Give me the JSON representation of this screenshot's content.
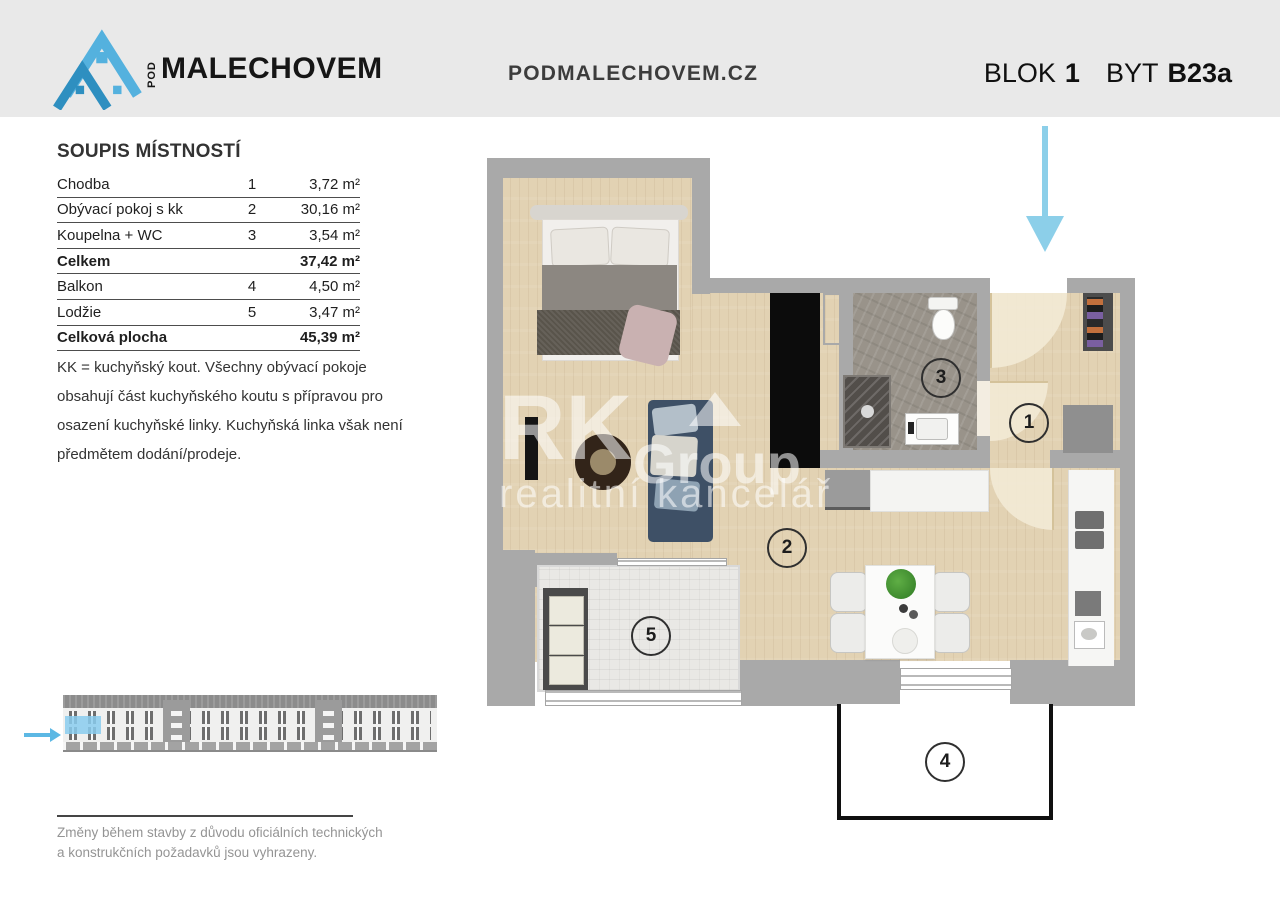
{
  "header": {
    "logo_pod": "POD",
    "logo_name": "MALECHOVEM",
    "website": "PODMALECHOVEM.CZ",
    "block_label": "BLOK",
    "block_value": "1",
    "unit_label": "BYT",
    "unit_value": "B23a"
  },
  "room_list": {
    "title": "SOUPIS MÍSTNOSTÍ",
    "rows": [
      {
        "name": "Chodba",
        "num": "1",
        "area": "3,72 m²",
        "bold": false
      },
      {
        "name": "Obývací pokoj s kk",
        "num": "2",
        "area": "30,16 m²",
        "bold": false
      },
      {
        "name": "Koupelna + WC",
        "num": "3",
        "area": "3,54 m²",
        "bold": false
      },
      {
        "name": "Celkem",
        "num": "",
        "area": "37,42 m²",
        "bold": true
      },
      {
        "name": "Balkon",
        "num": "4",
        "area": "4,50 m²",
        "bold": false
      },
      {
        "name": "Lodžie",
        "num": "5",
        "area": "3,47 m²",
        "bold": false
      },
      {
        "name": "Celková plocha",
        "num": "",
        "area": "45,39 m²",
        "bold": true
      }
    ]
  },
  "note": "KK = kuchyňský kout. Všechny obývací pokoje obsahují část kuchyňského koutu s přípravou pro osazení kuchyňské linky. Kuchyňská linka však není předmětem dodání/prodeje.",
  "disclaimer": "Změny během stavby z důvodu oficiálních technických a konstrukčních požadavků jsou vyhrazeny.",
  "floor_plan": {
    "room_labels": {
      "hallway": "1",
      "living": "2",
      "bathroom": "3",
      "balcony": "4",
      "loggia": "5"
    }
  },
  "watermark": {
    "line1": "RK",
    "line2": "Group",
    "line3": "realitní kancelář"
  },
  "colors": {
    "accent_blue": "#8ccfe9",
    "logo_blue": "#54b1de",
    "wall_gray": "#a9a9a9",
    "floor_wood": "#e2d2b3",
    "header_bg": "#e9e9e9"
  }
}
